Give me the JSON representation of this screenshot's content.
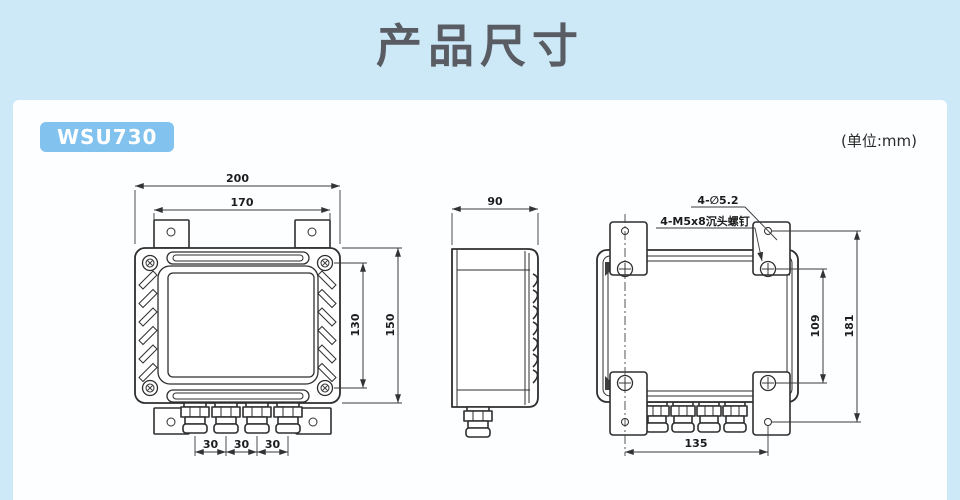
{
  "header": {
    "title": "产品尺寸"
  },
  "panel": {
    "model_badge": "WSU730",
    "unit_note": "(单位:mm)"
  },
  "colors": {
    "background": "#cde9f8",
    "panel": "#fcfeff",
    "badge": "#82c2ee",
    "title_text": "#595d63",
    "drawing_line": "#2e2e2e"
  },
  "views": {
    "front": {
      "dims": {
        "outer_width": "200",
        "bracket_width": "170",
        "screw_pitch_height": "130",
        "body_height": "150",
        "gland_pitch": [
          "30",
          "30",
          "30"
        ]
      }
    },
    "side": {
      "dims": {
        "depth": "90"
      }
    },
    "back": {
      "annotations": {
        "mounting_hole": "4-∅5.2",
        "countersunk_screw": "4-M5x8沉头螺钉"
      },
      "dims": {
        "screw_pitch_vertical": "109",
        "hole_pitch_vertical": "181",
        "hole_pitch_horizontal": "135"
      }
    }
  }
}
